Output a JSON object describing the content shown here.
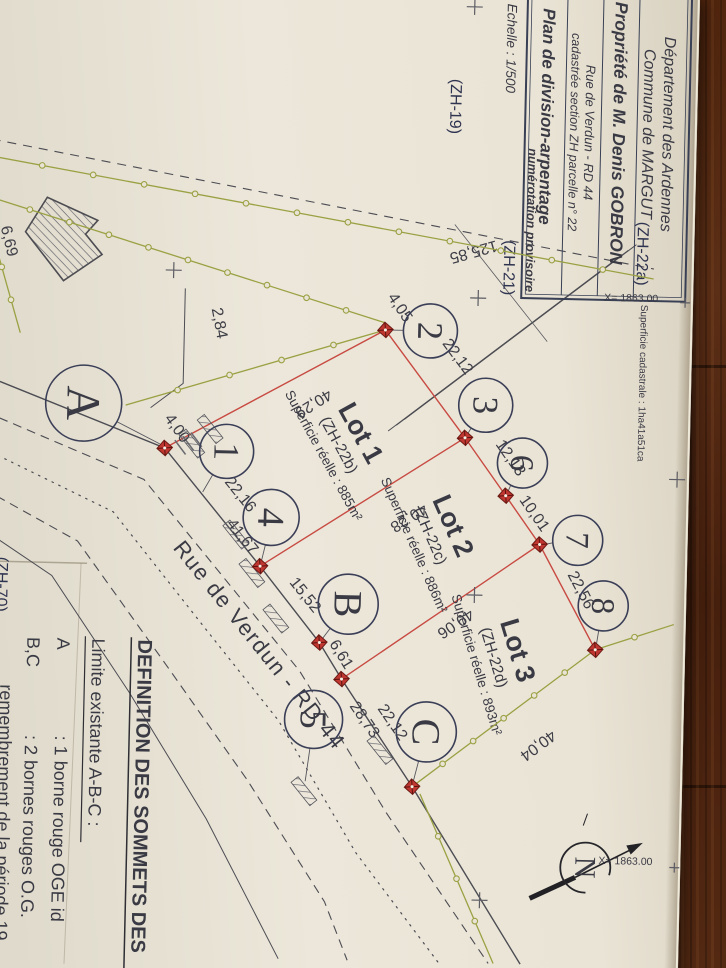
{
  "title_block": {
    "department": "Département des Ardennes",
    "commune": "Commune de MARGUT",
    "owner": "Propriété de M. Denis GOBRON",
    "address": "Rue de Verdun - RD 44",
    "cadastre": "cadastrée section ZH parcelle n° 22",
    "doc_title": "Plan de division-arpentage",
    "doc_note": "numérotation provisoire",
    "scale": "Echelle : 1/500"
  },
  "parcels": {
    "zh19": "(ZH-19)",
    "zh21": "(ZH-21)",
    "zh22a": "(ZH-22a)",
    "zh70": "(ZH-70)",
    "cadastral_area": "Superficie cadastrale : 1ha41a51ca"
  },
  "lots": [
    {
      "name": "Lot 1",
      "parcel": "(ZH-22b)",
      "area": "Superficie réelle : 885m²"
    },
    {
      "name": "Lot 2",
      "parcel": "(ZH-22c)",
      "area": "Superficie réelle : 886m²"
    },
    {
      "name": "Lot 3",
      "parcel": "(ZH-22d)",
      "area": "Superficie réelle : 893m²"
    }
  ],
  "points": {
    "pA": "A",
    "pB": "B",
    "pC": "C",
    "p1": "1",
    "p2": "2",
    "p3": "3",
    "p4": "4",
    "p5": "5",
    "p6": "6",
    "p7": "7",
    "p8": "8"
  },
  "measurements": {
    "m400": "4,00",
    "m405": "4,05",
    "m2212": "22,12",
    "m1213": "12,13",
    "m1001": "10,01",
    "m2256": "22,56",
    "m4029": "40,29",
    "m4028": "40,28",
    "m4006": "40,06",
    "m4004": "40,04",
    "m2216": "22,16",
    "m4167": "41,67",
    "m1552": "15,52",
    "m661": "6,61",
    "m2873": "28,73",
    "m2212b": "22,12",
    "m284": "2,84",
    "m12585": "125,85",
    "m669": "6,69"
  },
  "road": {
    "label": "Rue de Verdun - RD 44"
  },
  "grid": {
    "x_top": "X= 1863.00",
    "x_bottom": "X= 1863.00"
  },
  "north": {
    "label": "N"
  },
  "legend": {
    "heading": "DEFINITION DES SOMMETS DES",
    "subheading": "Limite existante A-B-C :",
    "item_a_key": "A",
    "item_a_text": ": 1 borne rouge OGE id",
    "item_bc_key": "B,C",
    "item_bc_text": ": 2 bornes rouges O.G.",
    "continuation": "remembrement de la période 19",
    "end": "agréé."
  },
  "colors": {
    "new_limit_red": "#c84a42",
    "existing_limit_green": "#9aa143",
    "title_blue": "#1c3bb0",
    "note_red": "#c81f1f",
    "paper": "#e9e3d6",
    "wood": "#4e2513"
  }
}
